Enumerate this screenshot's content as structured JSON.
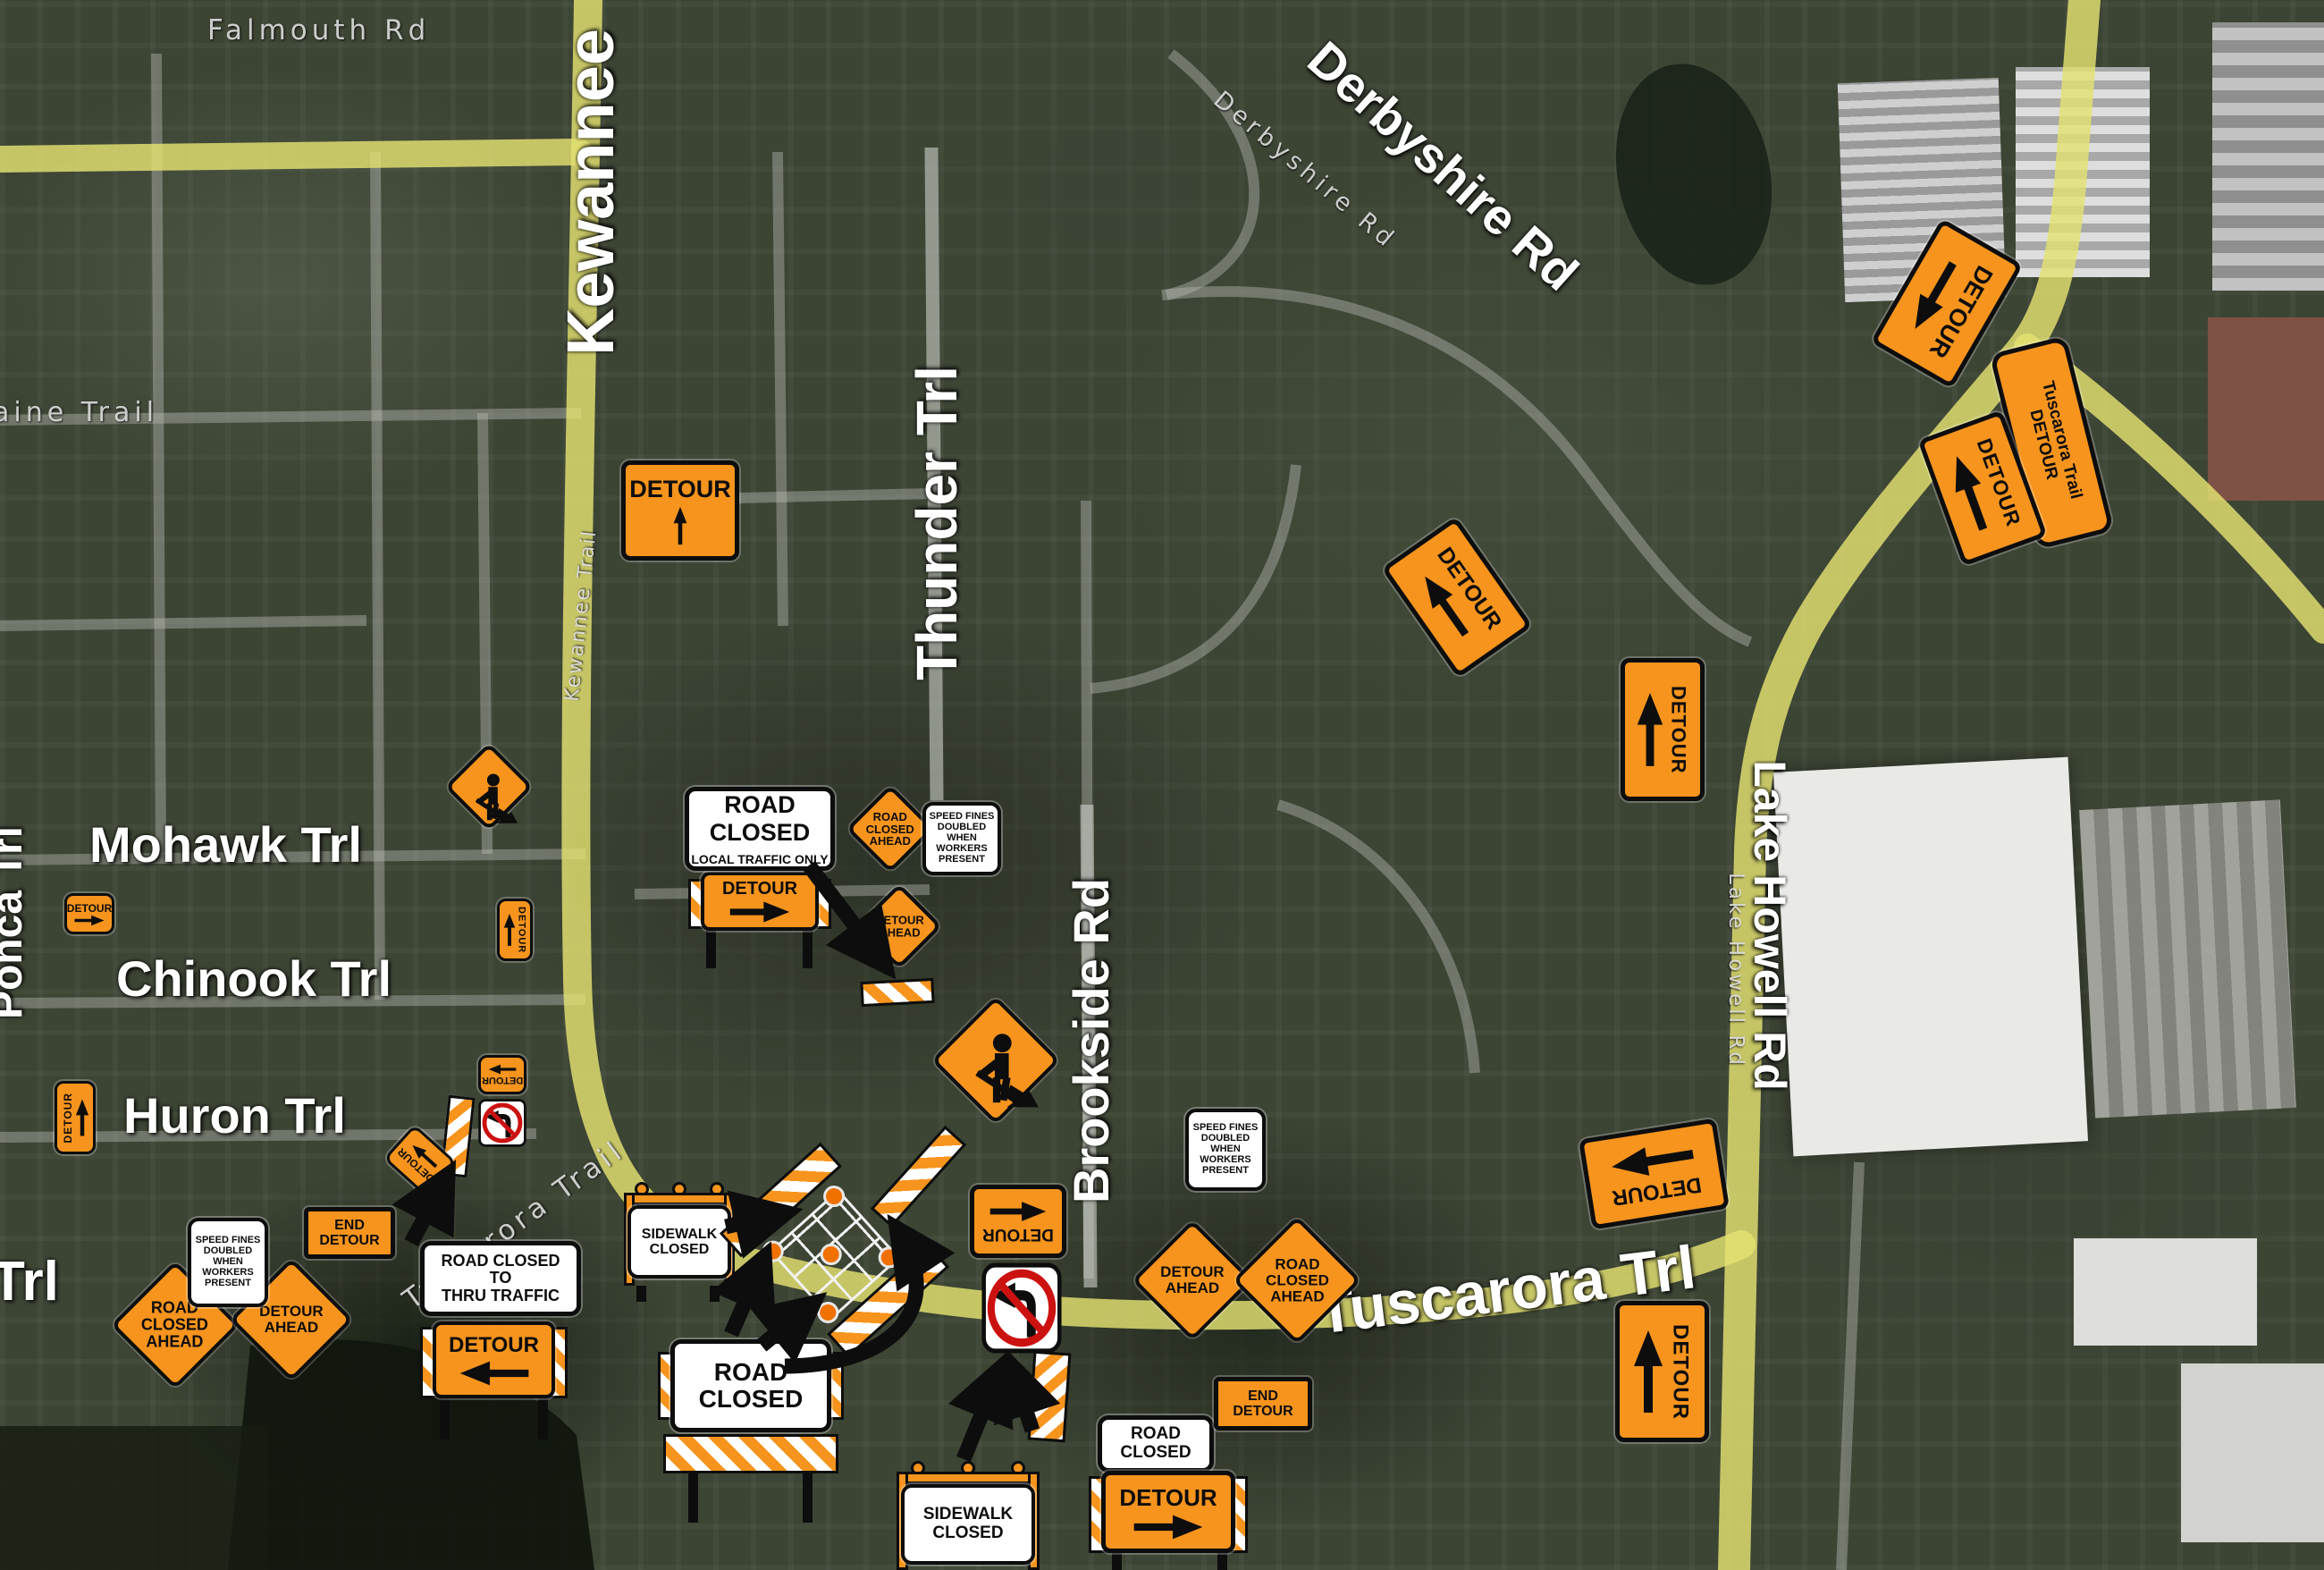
{
  "map": {
    "title": "Tuscarora Trail road closure detour map",
    "type": "satellite detour map"
  },
  "strings": {
    "detour": "DETOUR",
    "road_closed": "ROAD CLOSED",
    "local_traffic_only": "LOCAL TRAFFIC ONLY",
    "road_closed_2line": "ROAD\nCLOSED",
    "road_closed_ahead": "ROAD\nCLOSED\nAHEAD",
    "detour_ahead": "DETOUR\nAHEAD",
    "speed_fines": "SPEED FINES\nDOUBLED\nWHEN WORKERS\nPRESENT",
    "end_detour": "END\nDETOUR",
    "road_closed_to_thru_traffic": "ROAD CLOSED\nTO\nTHRU TRAFFIC",
    "sidewalk_closed": "SIDEWALK\nCLOSED",
    "tuscarora_trail_detour": "Tuscarora Trail\nDETOUR"
  },
  "road_labels": {
    "falmouth": "Falmouth Rd",
    "kewannee": "Kewannee",
    "kewannee_sat": "Kewannee Trail",
    "thunder": "Thunder Trl",
    "derbyshire": "Derbyshire Rd",
    "derbyshire_sat": "Derbyshire Rd",
    "brookside": "Brookside Rd",
    "lake_howell": "Lake Howell Rd",
    "lake_howell_sat": "Lake Howell Rd",
    "tuscarora": "Tuscarora Trl",
    "tuscarora_sat": "Tuscarora Trail",
    "mohawk": "Mohawk Trl",
    "chinook": "Chinook Trl",
    "huron": "Huron Trl",
    "trl_partial": "Trl",
    "ponca": "Ponca Trl",
    "aine_trail": "aine Trail"
  },
  "colors": {
    "sign_orange": "#F7941D",
    "sign_border": "#0d0d0d",
    "detour_route_yellow": "#E4E272",
    "label_white": "#FFFFFF",
    "no_turn_red": "#CC1111"
  }
}
